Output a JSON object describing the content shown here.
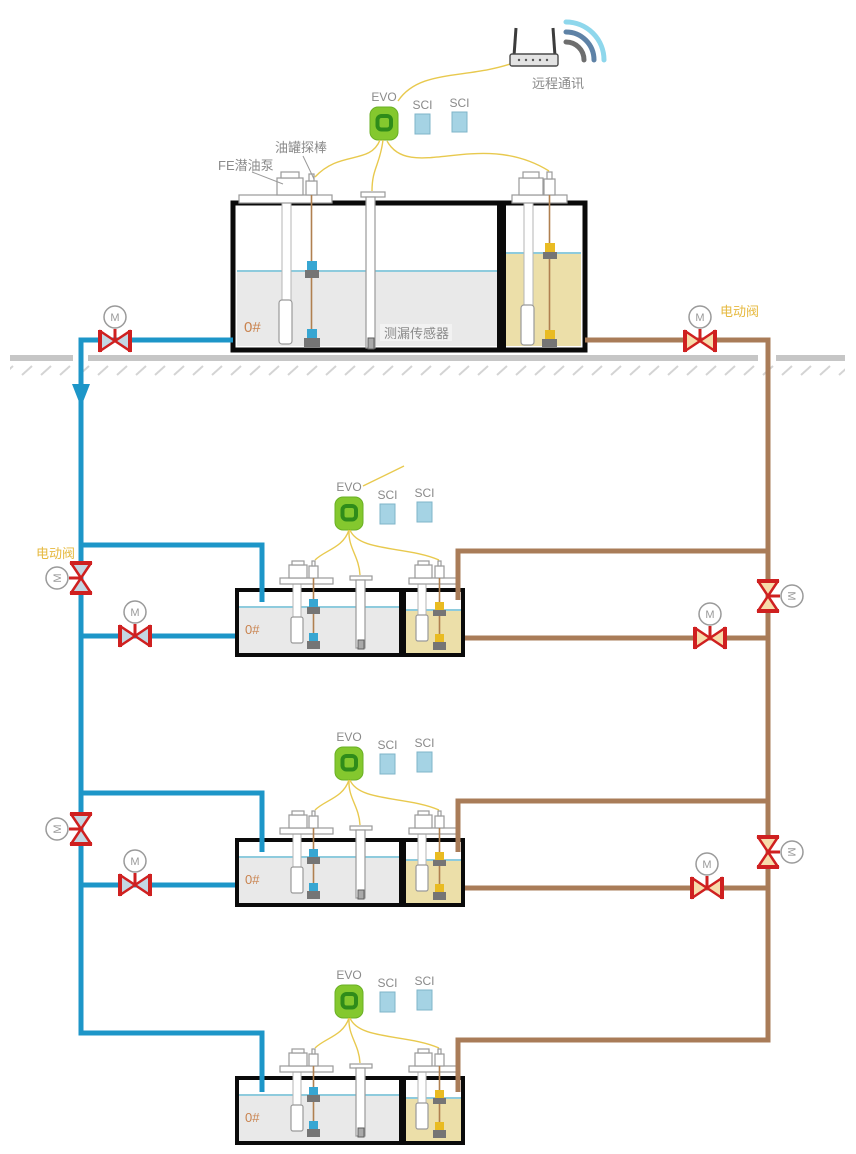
{
  "diagram": {
    "title": "fuel-station-underground-tank-monitoring-and-piping-diagram",
    "station_count": 4,
    "sci_modules_per_station": 2
  },
  "labels": {
    "remote_comm": "远程通讯",
    "evo": "EVO",
    "sci": "SCI",
    "tank_probe": "油罐探棒",
    "fe_pump": "FE潜油泵",
    "leak_sensor": "测漏传感器",
    "electric_valve": "电动阀",
    "motor": "M",
    "tank_grade": "0#"
  },
  "colors": {
    "supply_pipe_blue": "#1d96c8",
    "return_pipe_brown": "#a97c58",
    "valve_red": "#cf2020",
    "valve_wedge_blue": "#c3d7e3",
    "valve_wedge_tan": "#f7dcab",
    "signal_wire_yellow": "#e8c94e",
    "evo_green": "#84c82e",
    "sci_blue": "#a5d3e4",
    "liquid_gray": "#e9e9e9",
    "liquid_tan": "#ecdfa9",
    "ground_gray": "#c6c6c6",
    "grade_label_orange": "#c9834f",
    "gold_label": "#e6b93f"
  }
}
